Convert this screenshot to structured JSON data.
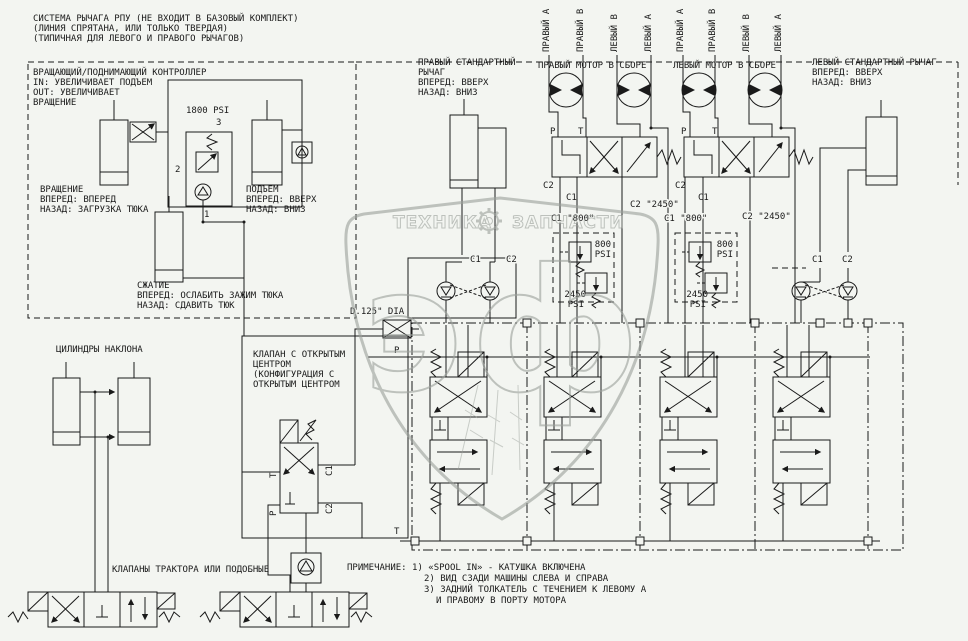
{
  "colors": {
    "line": "#1a1a1a",
    "watermark": "#9aa09a",
    "background": "#f3f5f1"
  },
  "top_note": {
    "line1": "СИСТЕМА РЫЧАГА РПУ (НЕ ВХОДИТ В БАЗОВЫЙ КОМПЛЕКТ)",
    "line2": "(ЛИНИЯ СПРЯТАНА, ИЛИ ТОЛЬКО ТВЕРДАЯ)",
    "line3": "(ТИПИЧНАЯ ДЛЯ ЛЕВОГО И ПРАВОГО РЫЧАГОВ)"
  },
  "controller": {
    "title1": "ВРАЩАЮЩИЙ/ПОДНИМАЮЩИЙ КОНТРОЛЛЕР",
    "title2": "IN: УВЕЛИЧИВАЕТ ПОДЪЕМ",
    "title3": "OUT: УВЕЛИЧИВАЕТ",
    "title4": "ВРАЩЕНИЕ",
    "pressure": "1800 PSI",
    "port3": "3",
    "port2": "2",
    "port1": "1",
    "rotation1": "ВРАЩЕНИЕ",
    "rotation2": "ВПЕРЕД: ВПЕРЕД",
    "rotation3": "НАЗАД: ЗАГРУЗКА ТЮКА",
    "lift1": "ПОДЪЕМ",
    "lift2": "ВПЕРЕД: ВВЕРХ",
    "lift3": "НАЗАД: ВНИЗ",
    "squeeze1": "СЖАТИЕ",
    "squeeze2": "ВПЕРЕД: ОСЛАБИТЬ ЗАЖИМ ТЮКА",
    "squeeze3": "НАЗАД: СДАВИТЬ ТЮК"
  },
  "right_lever": {
    "line1": "ПРАВЫЙ СТАНДАРТНЫЙ",
    "line2": "РЫЧАГ",
    "line3": "ВПЕРЕД: ВВЕРХ",
    "line4": "НАЗАД: ВНИЗ"
  },
  "left_lever": {
    "line1": "ЛЕВЫЙ СТАНДАРТНЫЙ РЫЧАГ",
    "line2": "ВПЕРЕД: ВВЕРХ",
    "line3": "НАЗАД: ВНИЗ"
  },
  "motor_ports": {
    "p1": "ПРАВЫЙ А",
    "p2": "ПРАВЫЙ В",
    "p3": "ЛЕВЫЙ В",
    "p4": "ЛЕВЫЙ А",
    "p5": "ПРАВЫЙ А",
    "p6": "ПРАВЫЙ В",
    "p7": "ЛЕВЫЙ В",
    "p8": "ЛЕВЫЙ А"
  },
  "motors": {
    "right": "ПРАВЫЙ МОТОР В СБОРЕ",
    "left": "ЛЕВЫЙ МОТОР В СБОРЕ"
  },
  "ports": {
    "P": "P",
    "T": "T",
    "C1": "C1",
    "C2": "C2"
  },
  "caps": {
    "c1_800": "C1 \"800\"",
    "c2_2450": "C2 \"2450\""
  },
  "relief": {
    "v800": "800",
    "v2450": "2450",
    "psi": "PSI"
  },
  "orifice": {
    "label": "D.125\" DIA"
  },
  "tilt": {
    "label": "ЦИЛИНДРЫ НАКЛОНА"
  },
  "open_center": {
    "line1": "КЛАПАН С ОТКРЫТЫМ",
    "line2": "ЦЕНТРОМ",
    "line3": "(КОНФИГУРАЦИЯ С",
    "line4": "ОТКРЫТЫМ ЦЕНТРОМ"
  },
  "tractor": {
    "label": "КЛАПАНЫ ТРАКТОРА ИЛИ ПОДОБНЫЕ"
  },
  "notes": {
    "line1": "ПРИМЕЧАНИЕ: 1) «SPOOL IN»  - КАТУШКА ВКЛЮЧЕНА",
    "line2": "2) ВИД СЗАДИ МАШИНЫ СЛЕВА И СПРАВА",
    "line3": "3) ЗАДНИЙ ТОЛКАТЕЛЬ С ТЕЧЕНИЕМ К ЛЕВОМУ А",
    "line4": "И ПРАВОМУ В ПОРТУ МОТОРА"
  },
  "watermark": {
    "word1": "ТЕХНИКА",
    "word2": "ЗАПЧАСТИ",
    "monogram": "эф"
  }
}
